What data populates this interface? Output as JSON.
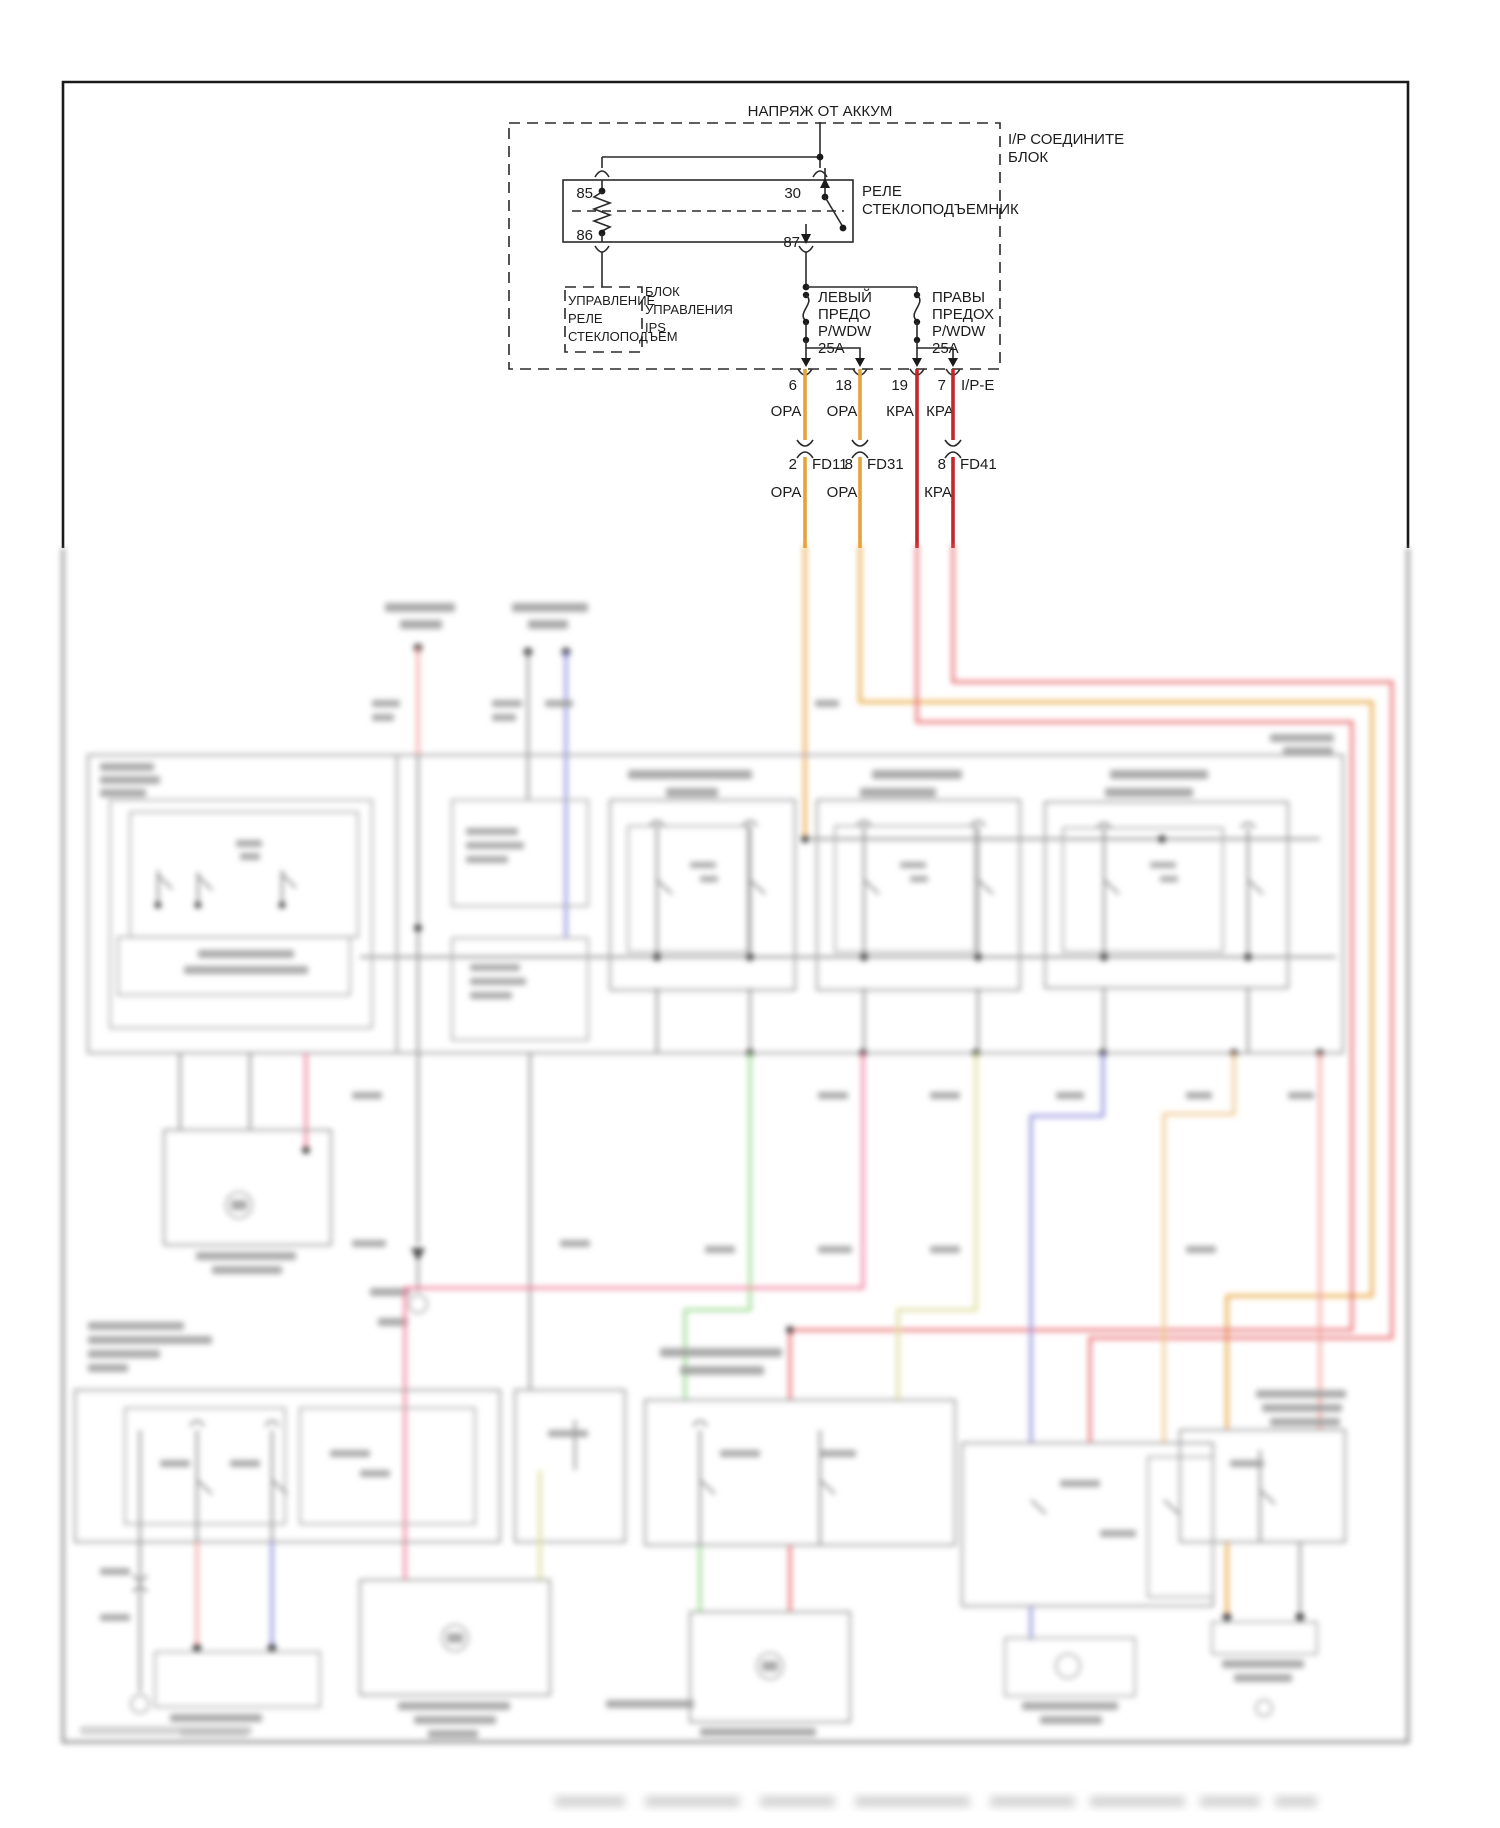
{
  "diagram": {
    "battery_label": "НАПРЯЖ ОТ АККУМ",
    "ip_connector_block": {
      "label_lines": [
        "I/P СОЕДИНИТЕ",
        "БЛОК"
      ]
    },
    "relay": {
      "label_lines": [
        "РЕЛЕ",
        "СТЕКЛОПОДЪЕМНИК"
      ],
      "pin_85": "85",
      "pin_86": "86",
      "pin_30": "30",
      "pin_87": "87"
    },
    "window_relay_control": {
      "label_lines": [
        "УПРАВЛЕНИЕ",
        "РЕЛЕ",
        "СТЕКЛОПОДЪЕМ"
      ]
    },
    "ips_control": {
      "label_lines": [
        "БЛОК",
        "УПРАВЛЕНИЯ",
        "IPS"
      ]
    },
    "fuse_left": {
      "label_lines": [
        "ЛЕВЫЙ",
        "ПРЕДО",
        "P/WDW",
        "25A"
      ]
    },
    "fuse_right": {
      "label_lines": [
        "ПРАВЫ",
        "ПРЕДОХ",
        "P/WDW",
        "25A"
      ]
    },
    "branch_pins": {
      "pin1": "6",
      "pin2": "18",
      "pin3": "19",
      "pin4": "7",
      "pin4_suffix": "I/P-E"
    },
    "wire_colors_row1": [
      "ОРА",
      "ОРА",
      "КРА",
      "КРА"
    ],
    "inline_connectors": [
      {
        "pin": "2",
        "label": "FD11"
      },
      {
        "pin": "8",
        "label": "FD31"
      },
      {
        "pin": "8",
        "label": "FD41"
      }
    ],
    "wire_colors_row2": [
      "ОРА",
      "ОРА",
      "КРА"
    ],
    "colors": {
      "orange_wire": "#E8A23B",
      "red_wire": "#C42629",
      "blur_salmon": "#F2A49E",
      "blur_pink": "#EE7F9E",
      "blur_green": "#97DB8C",
      "blur_yellow": "#DCDC96",
      "blur_blue": "#9090DC",
      "blur_tan": "#EFC488",
      "blur_red": "#E8686D"
    }
  }
}
